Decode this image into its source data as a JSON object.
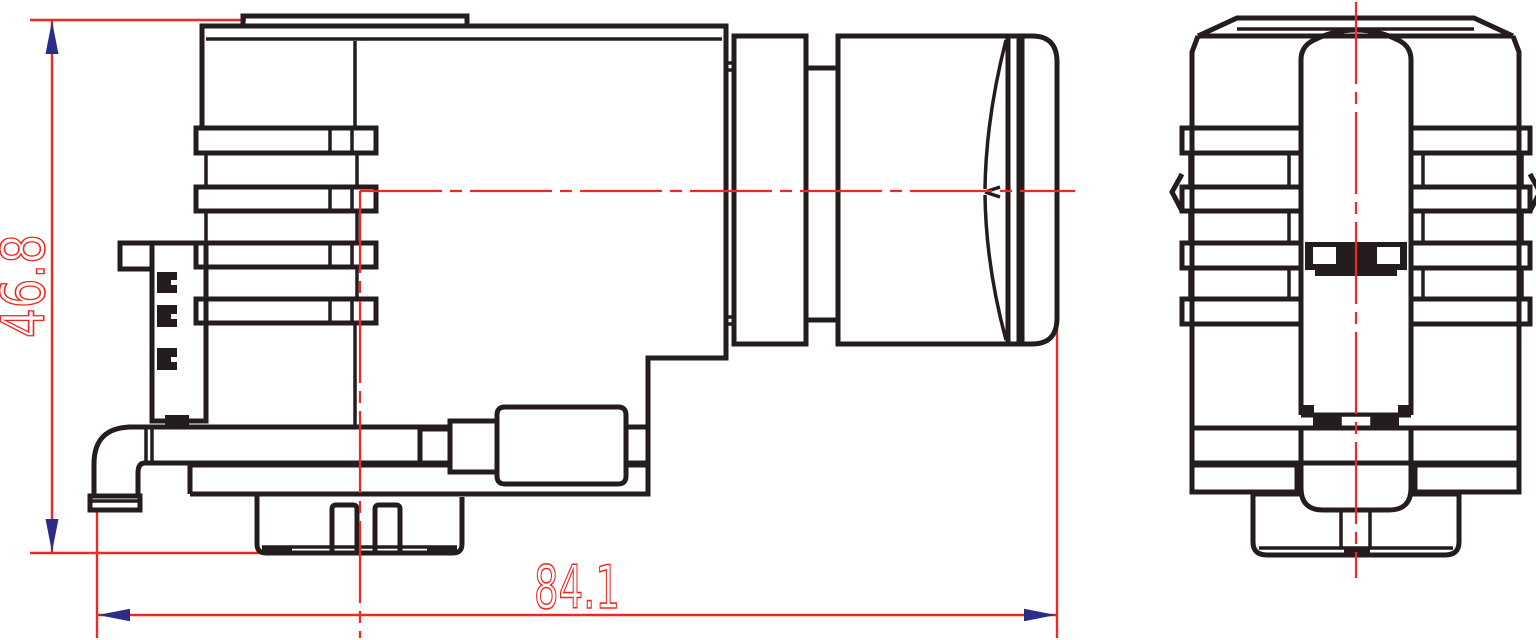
{
  "drawing": {
    "views": [
      {
        "name": "side-view"
      },
      {
        "name": "front-view"
      }
    ],
    "dimensions": {
      "height": {
        "value": "46.8",
        "orientation": "vertical"
      },
      "width": {
        "value": "84.1",
        "orientation": "horizontal"
      }
    },
    "colors": {
      "outline": "#251d1d",
      "dimension": "#ee2822",
      "arrowhead": "#2b2d86",
      "background": "#ffffff"
    }
  }
}
